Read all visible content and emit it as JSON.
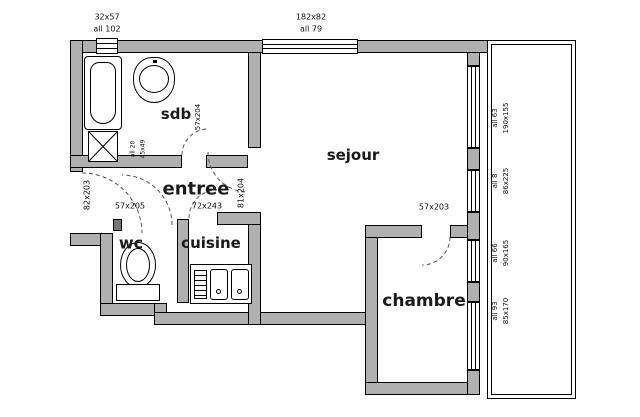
{
  "title": "apartment floor plan",
  "rooms": {
    "sdb": "sdb",
    "entree": "entree",
    "wc": "wc",
    "cuisine": "cuisine",
    "sejour": "sejour",
    "chambre": "chambre"
  },
  "openings": {
    "top_window_small": {
      "size": "32x57",
      "sill": "all 102"
    },
    "top_window_large": {
      "size": "182x82",
      "sill": "all 79"
    },
    "right_window_1": {
      "size": "190x155",
      "sill": "all 63"
    },
    "right_window_2": {
      "size": "86x225",
      "sill": "all 8"
    },
    "right_window_3": {
      "size": "90x165",
      "sill": "all 66"
    },
    "right_window_4": {
      "size": "85x170",
      "sill": "all 93"
    },
    "door_left": {
      "size": "82x203"
    },
    "door_sdb": {
      "size": "57x204"
    },
    "door_wc": {
      "size": "57x205"
    },
    "door_entry": {
      "size": "72x243"
    },
    "door_sejour": {
      "size": "81x204"
    },
    "door_chambre": {
      "size": "57x203"
    },
    "closet": {
      "size": "45x49",
      "sill": "all 20"
    }
  },
  "colors": {
    "wall": "#b0b0b0",
    "line": "#000000",
    "dash": "#555555",
    "background": "#ffffff"
  }
}
